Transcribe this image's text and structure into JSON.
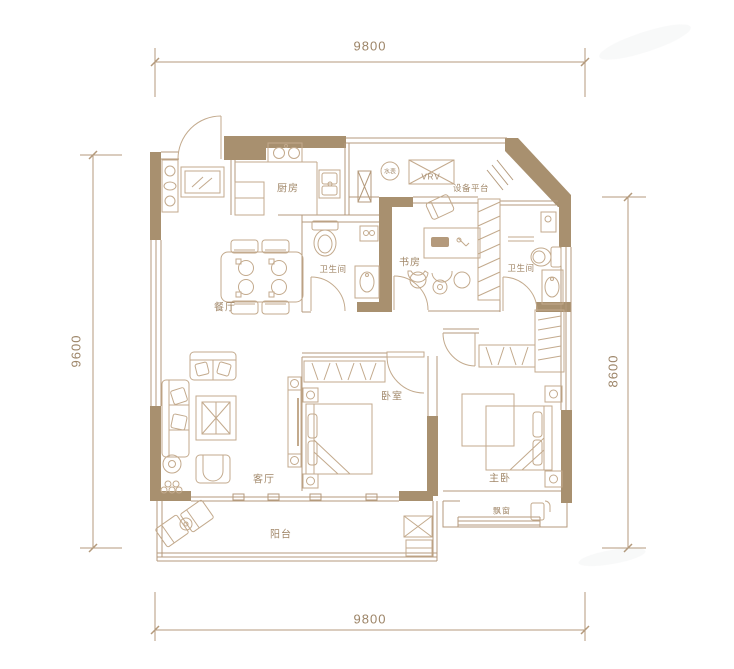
{
  "dimensions": {
    "top": "9800",
    "bottom": "9800",
    "left": "9600",
    "right": "8600"
  },
  "rooms": {
    "kitchen": "厨房",
    "dining": "餐厅",
    "bath_left": "卫生间",
    "study": "书房",
    "bath_right": "卫生间",
    "living": "客厅",
    "bedroom": "卧室",
    "master": "主卧",
    "balcony": "阳台",
    "bay_window": "飘窗",
    "equipment_platform": "设备平台",
    "water_meter": "水表",
    "vrv": "VRV"
  },
  "colors": {
    "wall": "#a8906f",
    "thin_wall": "#b49a7c",
    "furniture_line": "#c3aa8d",
    "label_text": "#a2886a",
    "dimension_text": "#9d8568",
    "background": "#ffffff"
  }
}
